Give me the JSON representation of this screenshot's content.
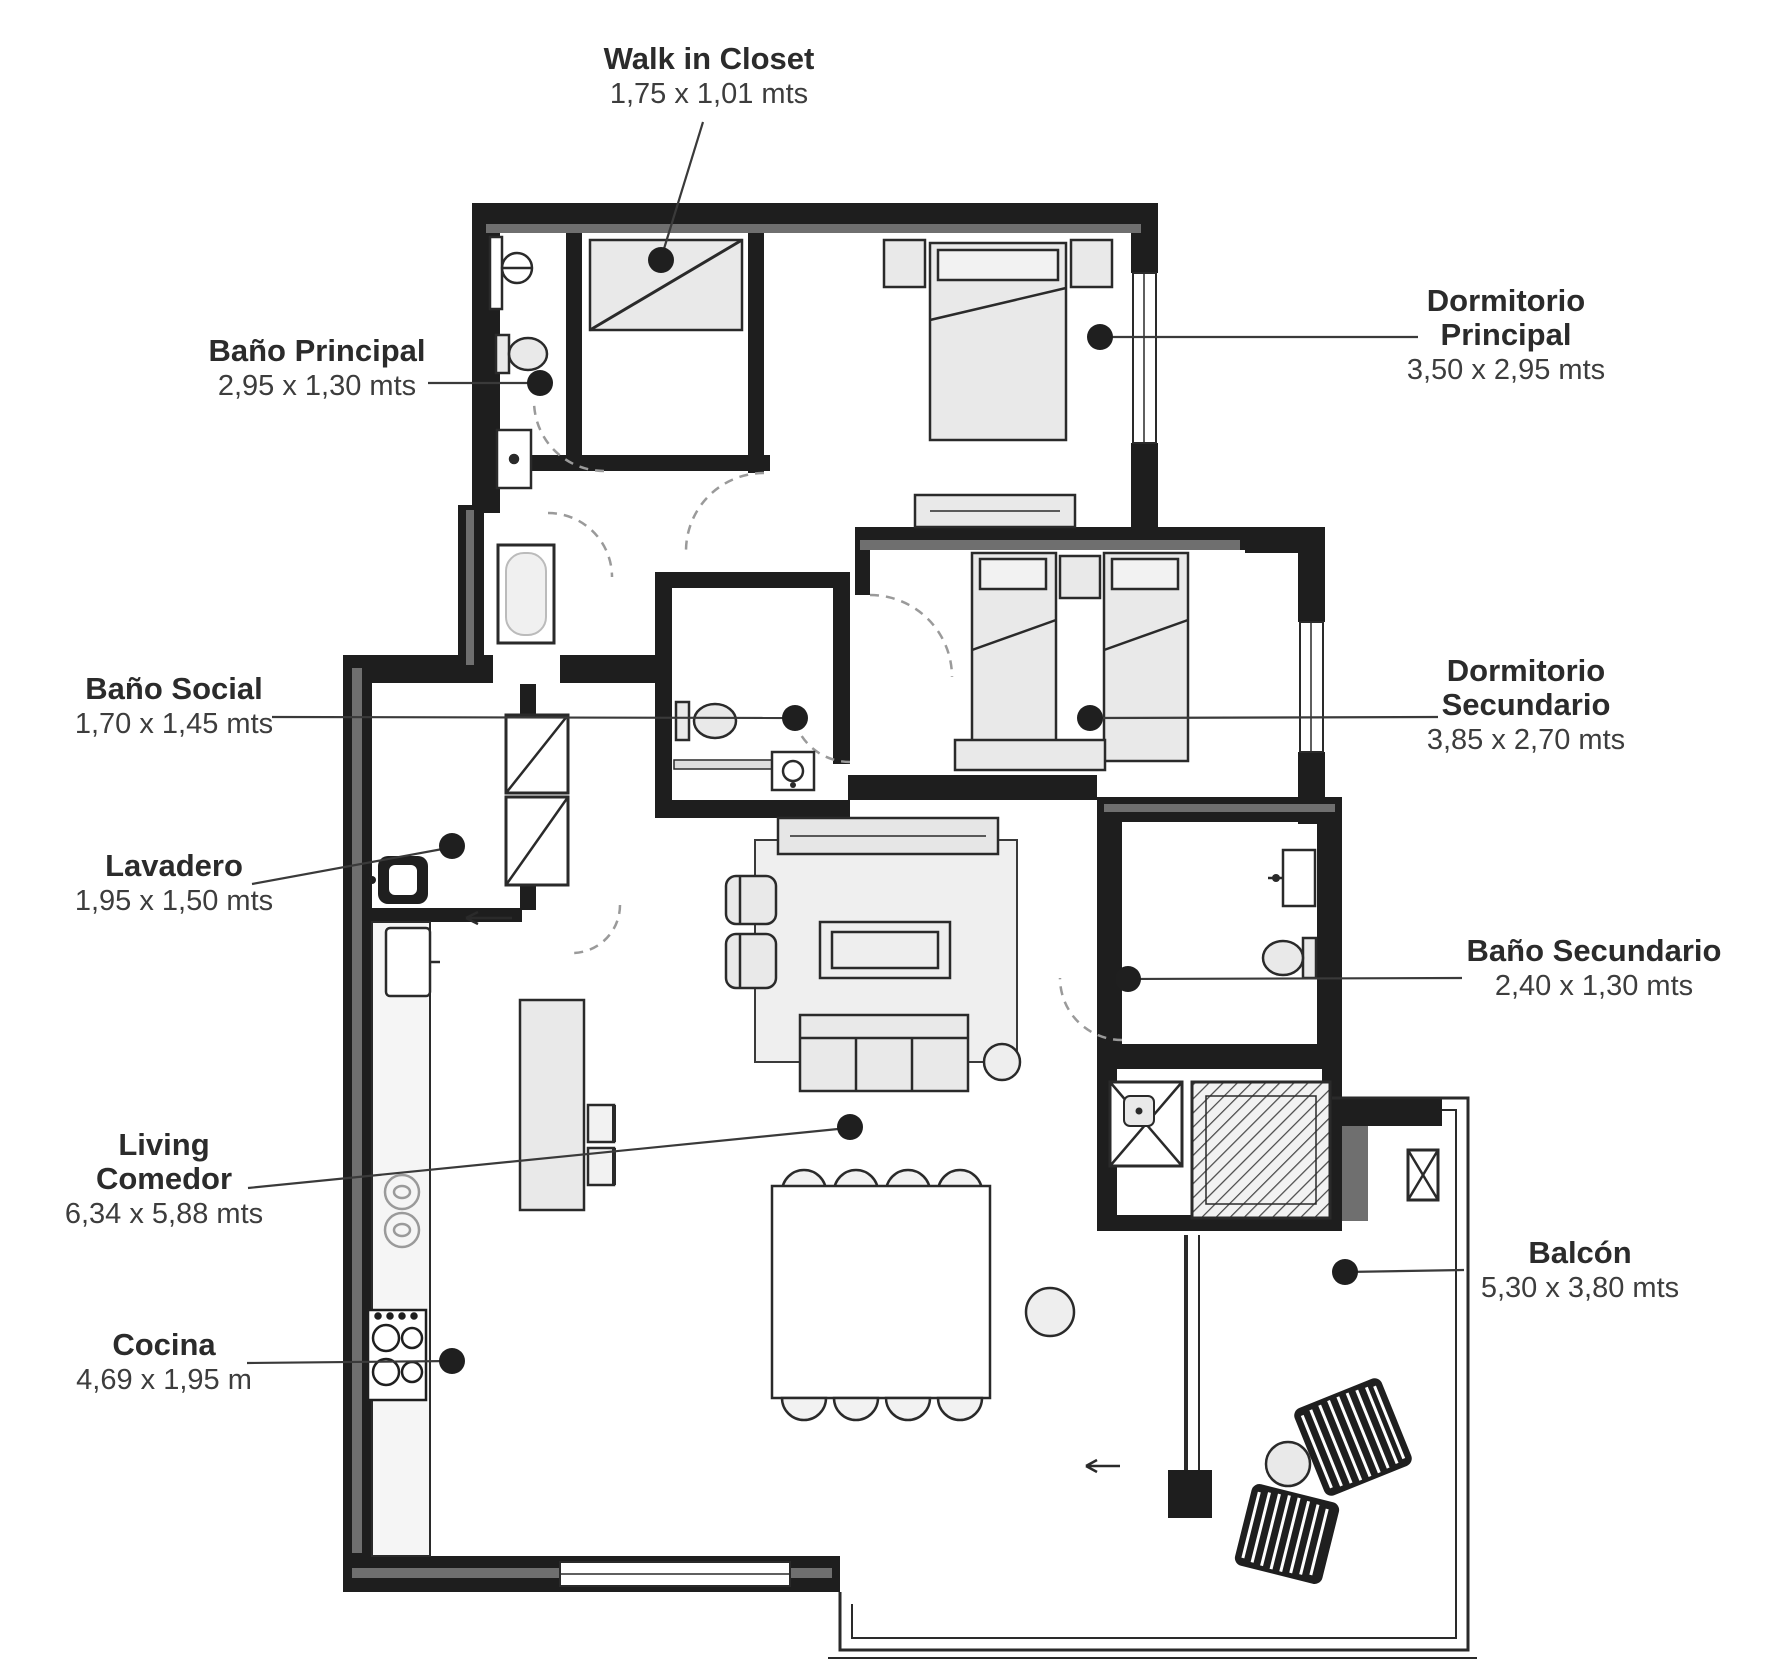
{
  "diagram": {
    "type": "floor-plan",
    "colors": {
      "wall": "#1e1e1e",
      "wall_accent": "#6f6f6f",
      "furniture_fill": "#e9e9e9",
      "label_text": "#2b2b2b",
      "leader_line": "#3a3a3a"
    },
    "rooms": [
      {
        "id": "walk-in-closet",
        "name": "Walk in Closet",
        "dimensions": "1,75 x 1,01 mts"
      },
      {
        "id": "dormitorio-principal",
        "name": "Dormitorio Principal",
        "dimensions": "3,50 x 2,95 mts"
      },
      {
        "id": "bano-principal",
        "name": "Baño Principal",
        "dimensions": "2,95 x 1,30 mts"
      },
      {
        "id": "bano-social",
        "name": "Baño Social",
        "dimensions": "1,70 x 1,45 mts"
      },
      {
        "id": "dormitorio-secundario",
        "name": "Dormitorio Secundario",
        "dimensions": "3,85 x 2,70 mts"
      },
      {
        "id": "lavadero",
        "name": "Lavadero",
        "dimensions": "1,95 x 1,50 mts"
      },
      {
        "id": "bano-secundario",
        "name": "Baño Secundario",
        "dimensions": "2,40 x 1,30 mts"
      },
      {
        "id": "living-comedor",
        "name": "Living Comedor",
        "dimensions": "6,34 x 5,88 mts"
      },
      {
        "id": "balcon",
        "name": "Balcón",
        "dimensions": "5,30 x 3,80 mts"
      },
      {
        "id": "cocina",
        "name": "Cocina",
        "dimensions": "4,69 x 1,95 m"
      }
    ]
  }
}
